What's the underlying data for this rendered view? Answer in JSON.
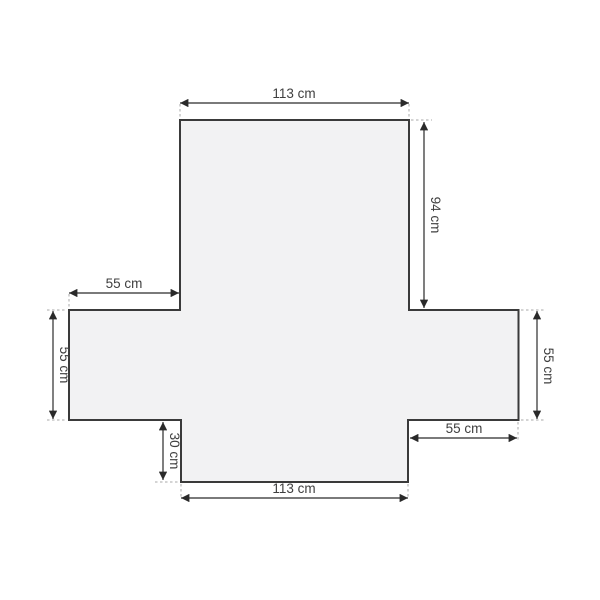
{
  "diagram": {
    "description": "Flat-lay dimension diagram of a cross-shaped armchair cover",
    "labels": {
      "top_width": "113 cm",
      "back_height": "94 cm",
      "left_arm_width": "55 cm",
      "left_arm_height": "55 cm",
      "right_arm_height": "55 cm",
      "right_arm_width": "55 cm",
      "front_skirt_height": "30 cm",
      "bottom_width": "113 cm"
    },
    "colors": {
      "background": "#ffffff",
      "shape_fill": "#f2f2f3",
      "shape_stroke": "#3a3a3a",
      "dimension_line": "#2a2a2a",
      "extension_line": "#a8a8a8",
      "label_text": "#3f3f3f"
    }
  }
}
